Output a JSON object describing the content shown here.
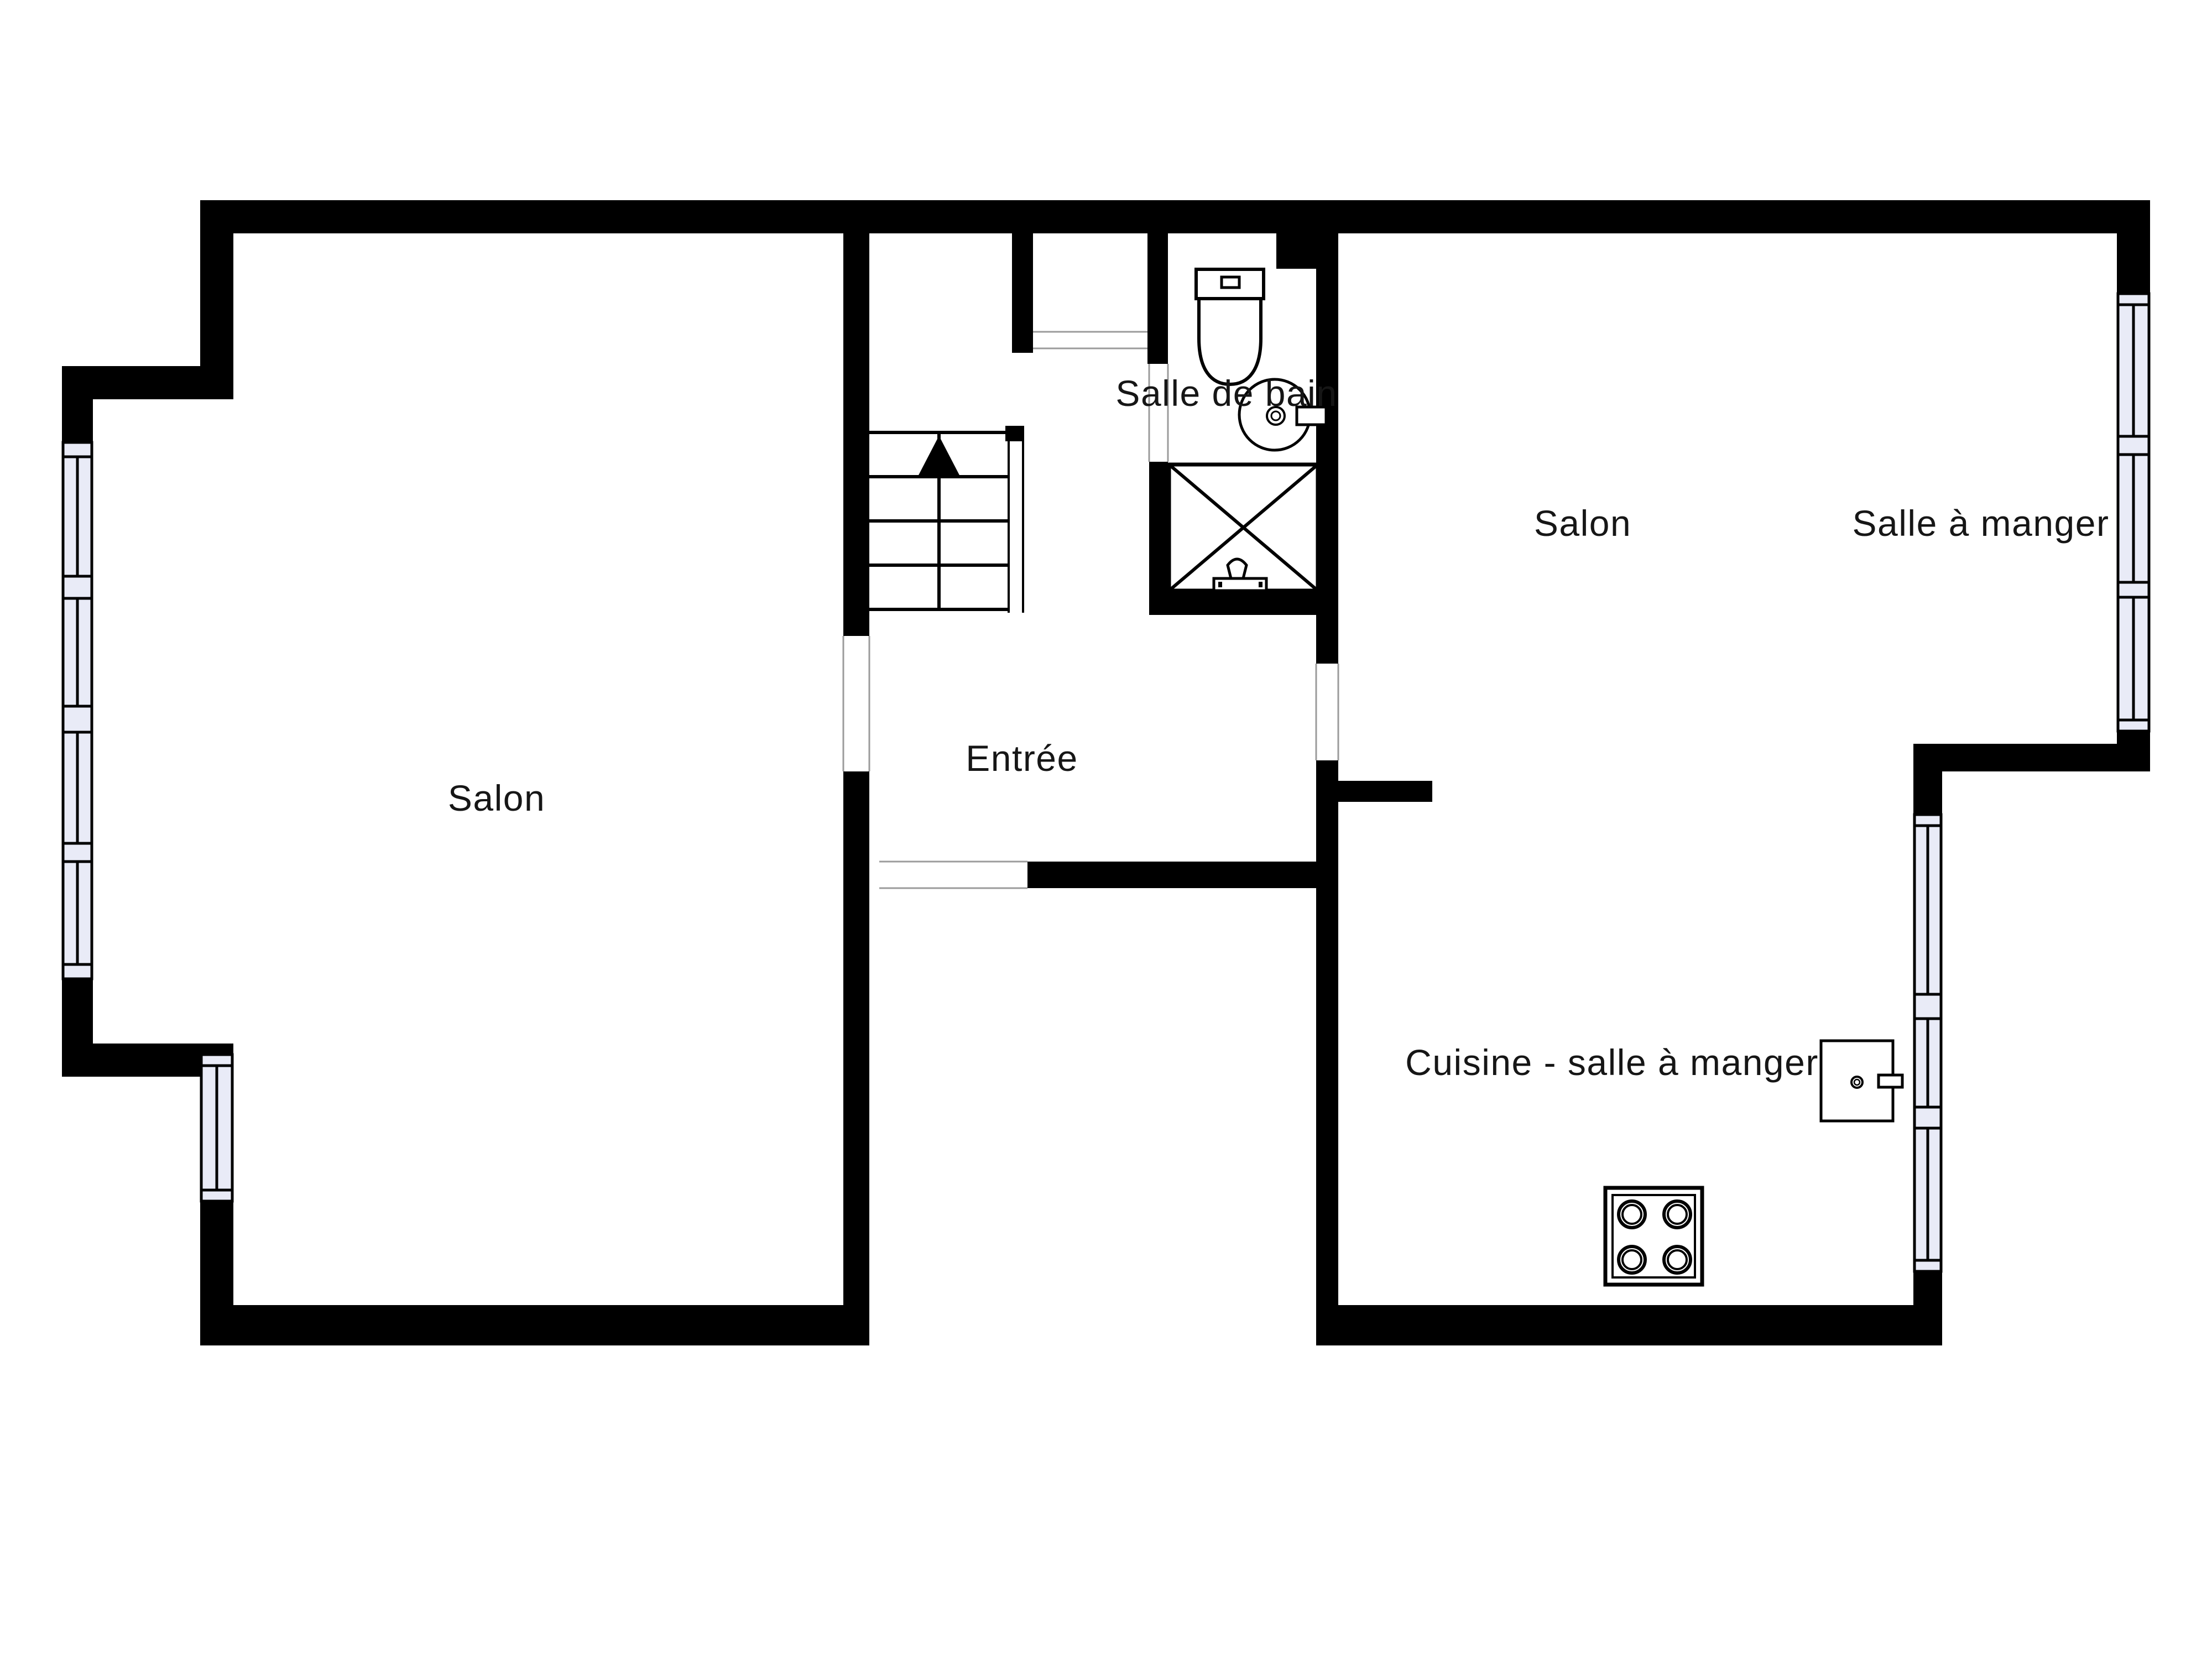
{
  "title": "Floor plan",
  "colors": {
    "background": "#ffffff",
    "wall": "#000000",
    "window_fill": "#e9ebf7",
    "window_frame": "#000000",
    "door_line": "#9b9b9b",
    "label": "#161616"
  },
  "rooms": [
    {
      "name": "salon-left",
      "label": "Salon"
    },
    {
      "name": "entree",
      "label": "Entrée"
    },
    {
      "name": "salle-de-bain",
      "label": "Salle de bain"
    },
    {
      "name": "salon-right",
      "label": "Salon"
    },
    {
      "name": "salle-a-manger",
      "label": "Salle à manger"
    },
    {
      "name": "cuisine-salle-a-manger",
      "label": "Cuisine - salle à manger"
    }
  ],
  "fixtures": [
    {
      "name": "stairs-up-icon"
    },
    {
      "name": "toilet-icon"
    },
    {
      "name": "washbasin-icon"
    },
    {
      "name": "shower-icon"
    },
    {
      "name": "stove-icon"
    },
    {
      "name": "kitchen-sink-icon"
    }
  ],
  "windows": {
    "left_wall_panes": 4,
    "lower_left_wall_panes": 1,
    "right_wall_panes": 3,
    "lower_right_wall_panes": 3
  },
  "stairs": {
    "direction": "up",
    "steps": 4
  }
}
